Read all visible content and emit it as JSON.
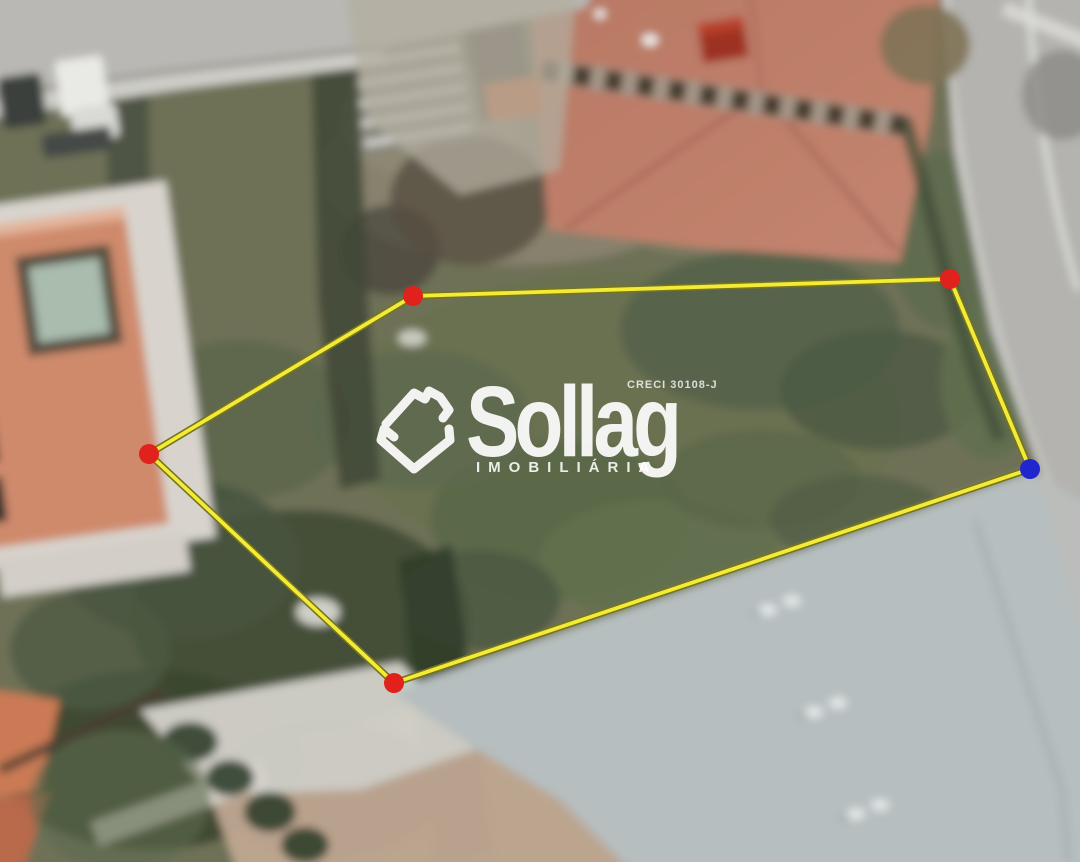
{
  "page": {
    "type": "aerial-lot-photo",
    "width_px": 1080,
    "height_px": 862
  },
  "watermark": {
    "brand": "Sollag",
    "subtitle": "IMOBILIÁRIA",
    "license": "CRECI 30108-J",
    "icon": "sollag-house-icon",
    "color": "#ffffff"
  },
  "overlay": {
    "boundary_color": "#f3eb37",
    "boundary_outline_color": "#75751e",
    "marker_radius": 10,
    "vertices": [
      {
        "id": "top-left",
        "x": 413,
        "y": 296,
        "marker": "red",
        "color": "#e0211c"
      },
      {
        "id": "top-right",
        "x": 950,
        "y": 279,
        "marker": "red",
        "color": "#e0211c"
      },
      {
        "id": "right",
        "x": 1030,
        "y": 469,
        "marker": "blue",
        "color": "#2125cd"
      },
      {
        "id": "bottom",
        "x": 394,
        "y": 683,
        "marker": "red",
        "color": "#e0211c"
      },
      {
        "id": "left",
        "x": 149,
        "y": 454,
        "marker": "red",
        "color": "#e0211c"
      }
    ]
  },
  "scene": {
    "colors": {
      "vegetation_olive": "#6e7157",
      "tree_shadow": "#3a452f",
      "terracotta_roof": "#c08069",
      "left_house_roof": "#cf8a6c",
      "warehouse_roof": "#b6bebf",
      "road_gray": "#b7b6b2",
      "sidewalk": "#cecdc8",
      "paving_light": "#d2d0c8",
      "dirt_tan": "#c2ab96"
    }
  }
}
